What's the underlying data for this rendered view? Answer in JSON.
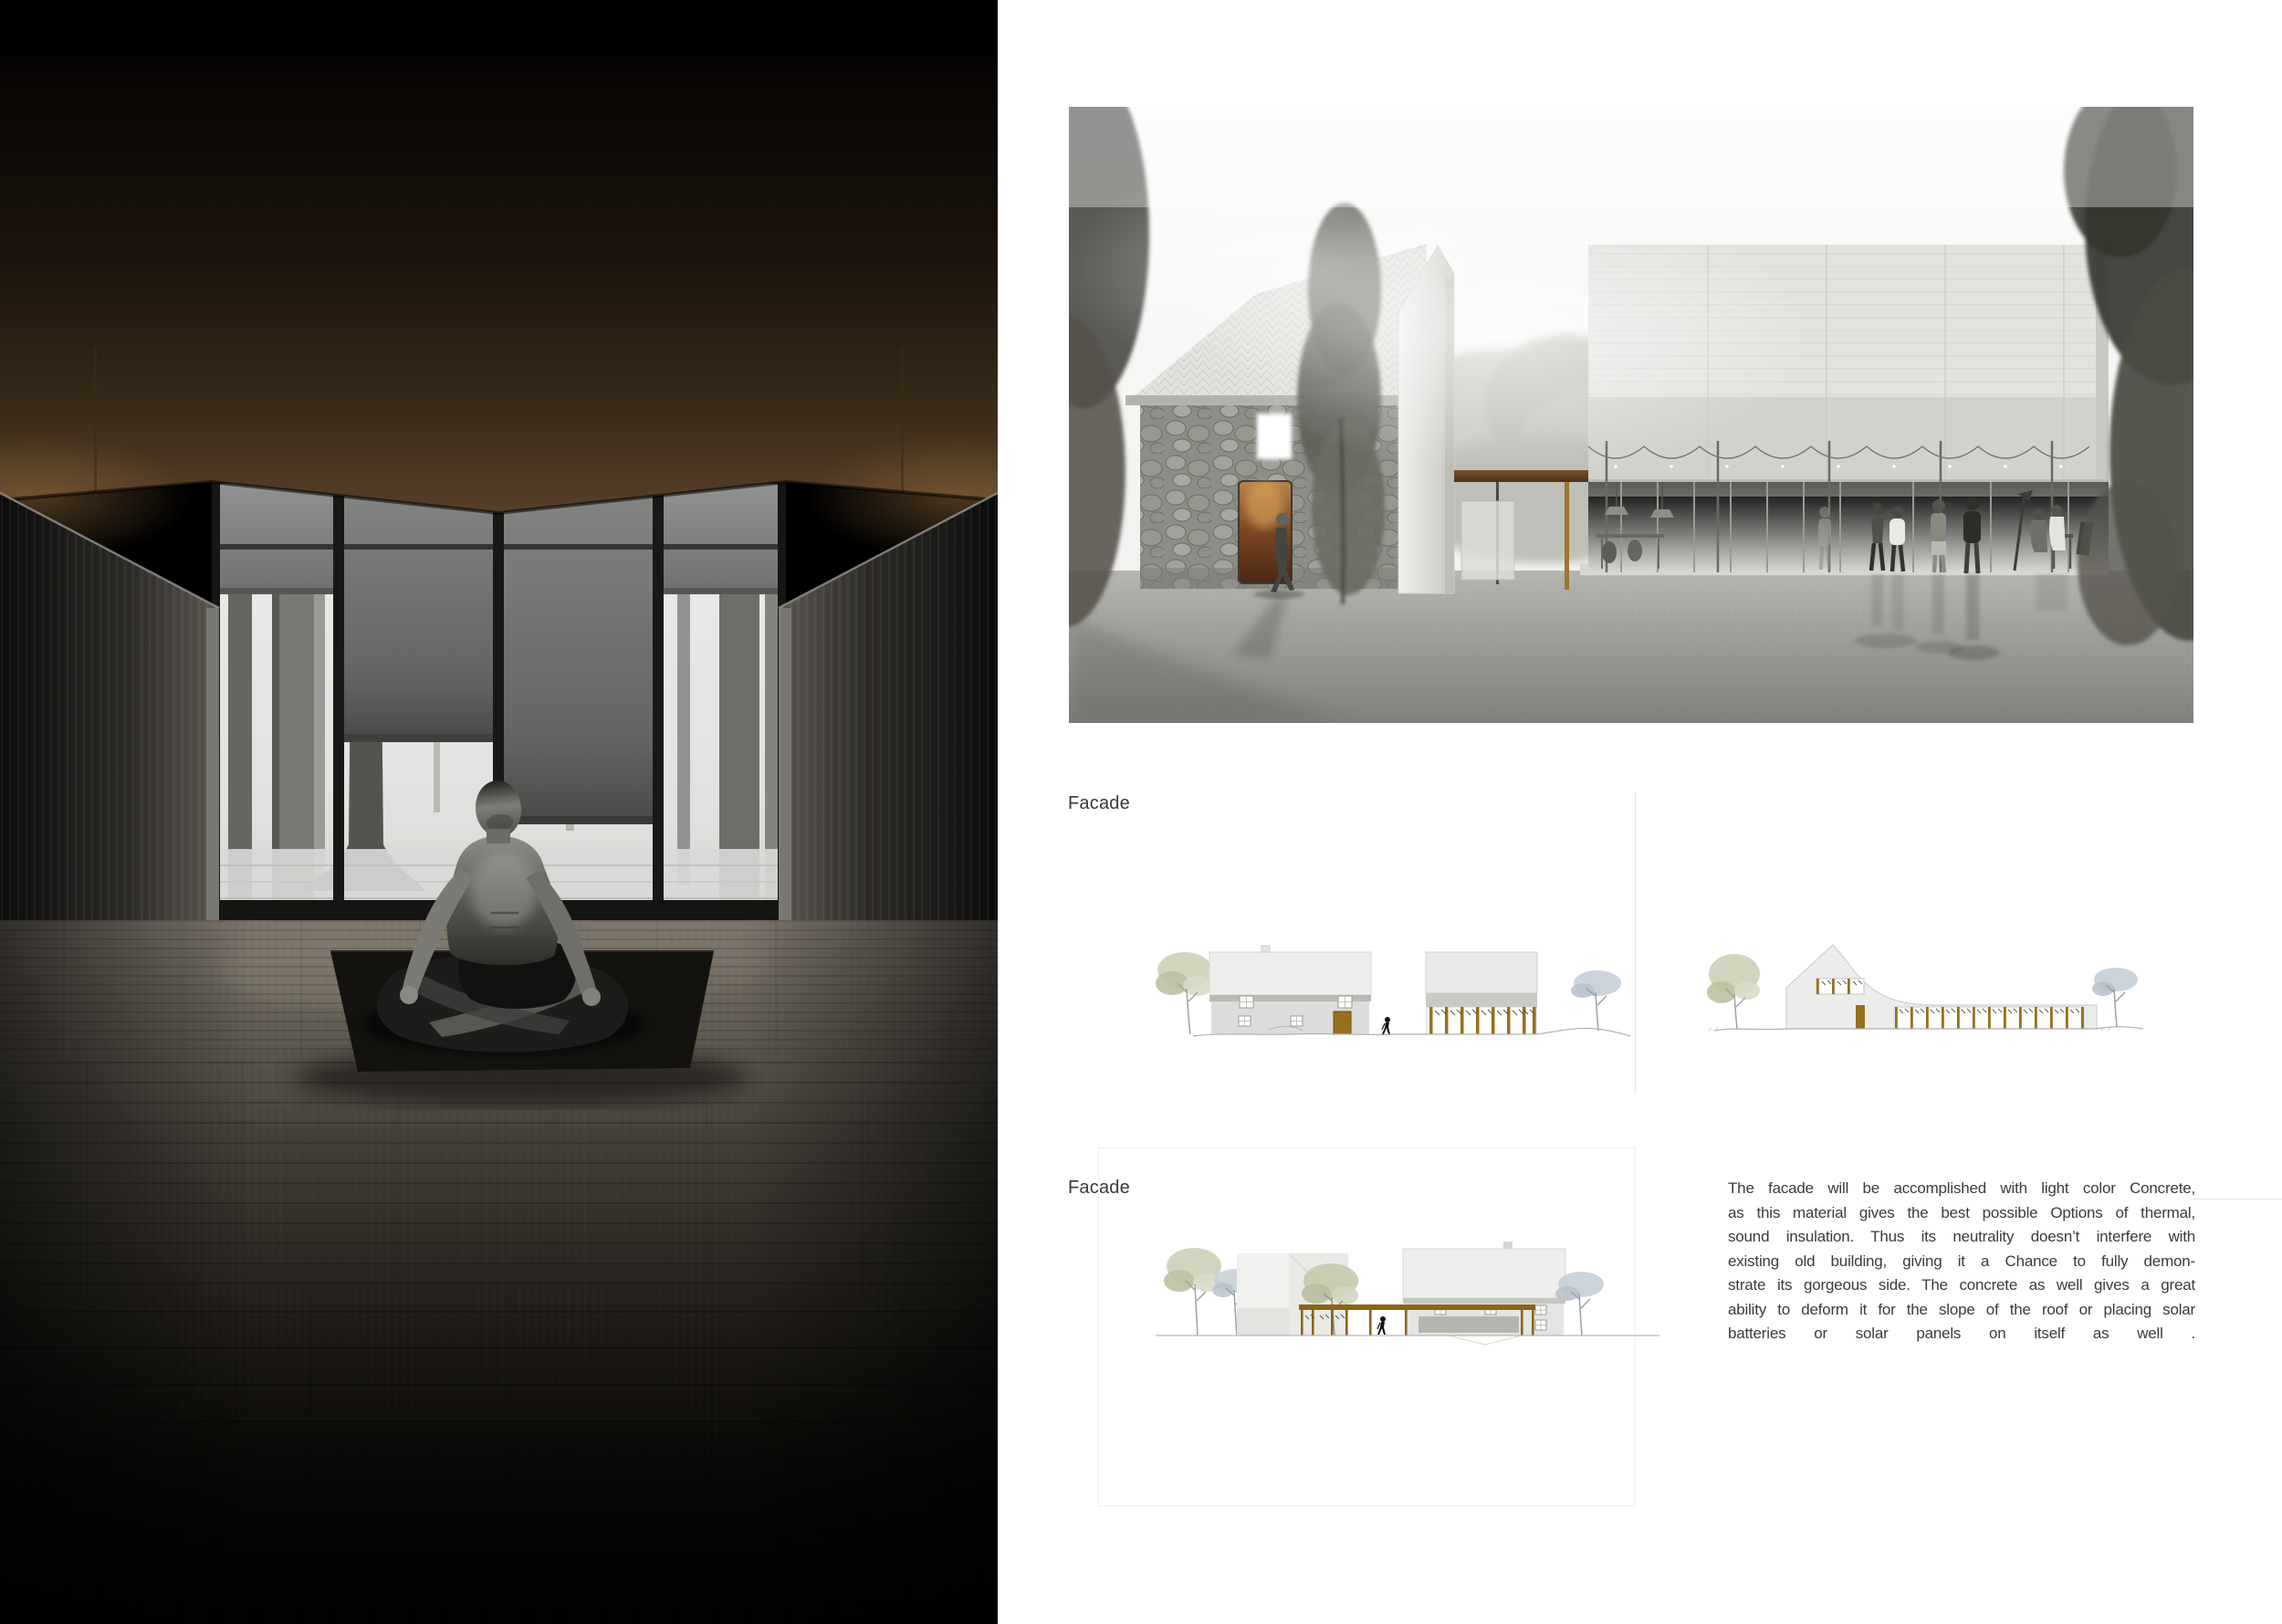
{
  "labels": {
    "facade_section_1": "Facade",
    "facade_section_2": "Facade"
  },
  "facade_text": {
    "lines": [
      "The facade will be accomplished with light color Concrete,",
      "as this material gives the best possible Options of thermal,",
      "sound insulation. Thus its neutrality doesn’t interfere with",
      "existing old building, giving it a Chance to fully demon-",
      "strate its gorgeous side. The concrete as well gives a great",
      "ability to deform it for the slope of the roof or placing solar",
      "batteries or solar panels    on itself as well ."
    ]
  },
  "colors": {
    "page_background": "#ffffff",
    "label_text": "#3a3a3a",
    "body_text": "#3b3b3b",
    "drawing_wood_accent": "#96701c",
    "render_pergola_brown": "#6b4428",
    "render_door_warm": "#8a5a30",
    "interior_ceiling_bronze": "#57402a",
    "hairline_gray": "#e2e2e2"
  }
}
